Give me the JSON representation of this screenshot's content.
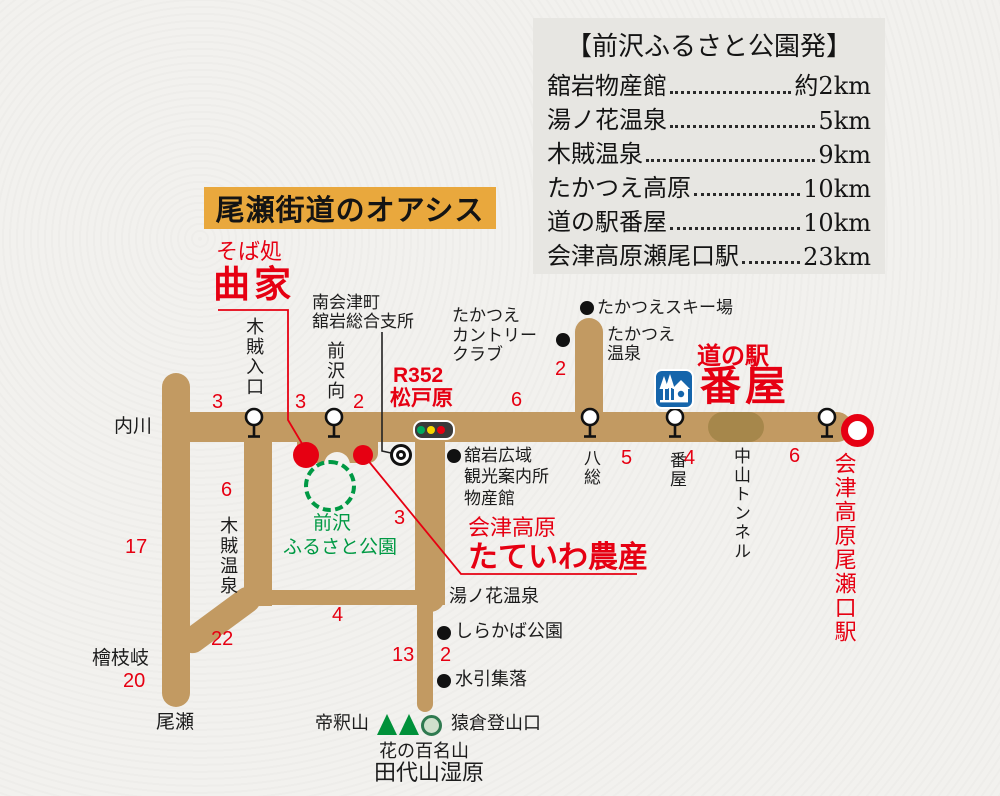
{
  "title": "尾瀬街道のオアシス",
  "info_box": {
    "title": "【前沢ふるさと公園発】",
    "rows": [
      {
        "label": "舘岩物産館",
        "value": "約2km"
      },
      {
        "label": "湯ノ花温泉",
        "value": "5km"
      },
      {
        "label": "木賊温泉",
        "value": "9km"
      },
      {
        "label": "たかつえ高原",
        "value": "10km"
      },
      {
        "label": "道の駅番屋",
        "value": "10km"
      },
      {
        "label": "会津高原瀬尾口駅",
        "value": "23km"
      }
    ]
  },
  "pois": {
    "soba": {
      "prefix": "そば処",
      "name": "曲家"
    },
    "branch_office": {
      "line1": "南会津町",
      "line2": "舘岩総合支所"
    },
    "r352": {
      "route": "R352",
      "name": "松戸原"
    },
    "country_club": {
      "line1": "たかつえ",
      "line2": "カントリー",
      "line3": "クラブ"
    },
    "ski_resort": "たかつえスキー場",
    "takatsue_onsen": {
      "line1": "たかつえ",
      "line2": "温泉"
    },
    "michinoeki": {
      "prefix": "道の駅",
      "name": "番屋"
    },
    "info_center": {
      "line1": "舘岩広域",
      "line2": "観光案内所",
      "line3": "物産館"
    },
    "park": {
      "line1": "前沢",
      "line2": "ふるさと公園"
    },
    "tateiwa_nosan": {
      "prefix": "会津高原",
      "name": "たていわ農産"
    },
    "station": "会津高原尾瀬口駅",
    "uchikawa": "内川",
    "hinoemata": "檜枝岐",
    "oze": "尾瀬",
    "yunohana_onsen": "湯ノ花温泉",
    "tokusa_onsen": "木賊温泉",
    "nakayama_tunnel": "中山トンネル",
    "shirakaba_park": "しらかば公園",
    "mizuhiki": "水引集落",
    "taishakuzan": "帝釈山",
    "sarukura": "猿倉登山口",
    "hana_hyakumeizan": "花の百名山",
    "tashiroyama": "田代山湿原"
  },
  "bus_stops": {
    "tokusa_iriguchi": "木賊入口",
    "maezawa_mukai": "前沢向",
    "hassou": "八総",
    "banya": "番屋"
  },
  "segments": {
    "west_of_tokusa_iriguchi": "3",
    "tokusa_to_maezawa": "3",
    "maezawa_to_matsudohara": "2",
    "matsudohara_to_hassou": "6",
    "hassou_to_banya": "5",
    "banya_to_tunnel": "4",
    "tunnel_to_station": "6",
    "takatsue_branch": "2",
    "tokusa_onsen_road": "6",
    "hinoemata_north": "17",
    "hinoemata_south": "20",
    "tokusa_diagonal": "22",
    "loop_bottom": "4",
    "loop_right": "3",
    "yunohana_south": "13",
    "shirakaba_spur": "2"
  },
  "colors": {
    "accent_red": "#e60012",
    "road_tan": "#c29a62",
    "tunnel_brown": "#a6874b",
    "map_green": "#009944",
    "title_bg": "#e9a83d",
    "info_box_bg": "#e7e6e2",
    "michinoeki_blue": "#1565ab"
  }
}
